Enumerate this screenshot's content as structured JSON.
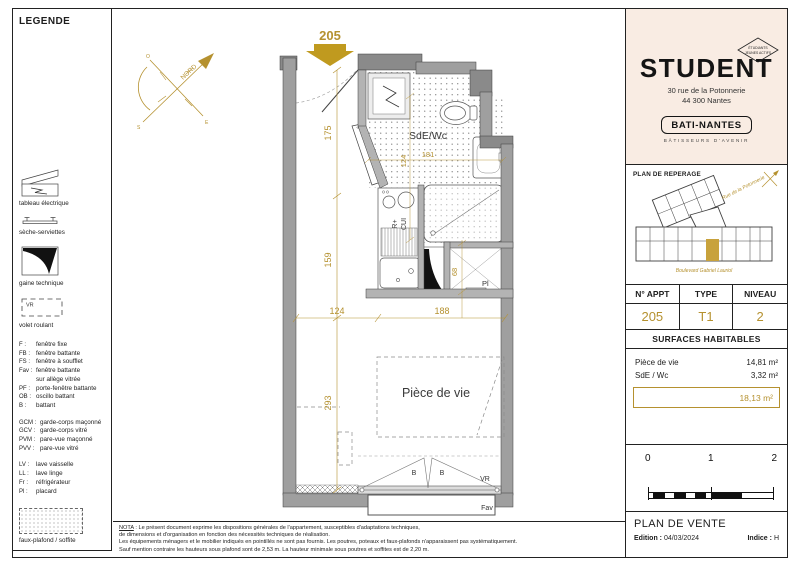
{
  "colors": {
    "accent": "#b5912f",
    "cream": "#f9ece3"
  },
  "legend": {
    "title": "LEGENDE",
    "items": [
      {
        "label": "tableau électrique"
      },
      {
        "label": "sèche-serviettes"
      },
      {
        "label": "gaine technique"
      },
      {
        "label": "volet roulant",
        "tag": "VR"
      }
    ],
    "abbrevs": [
      {
        "abbr": "F :",
        "label": "fenêtre fixe"
      },
      {
        "abbr": "FB :",
        "label": "fenêtre battante"
      },
      {
        "abbr": "FS :",
        "label": "fenêtre à soufflet"
      },
      {
        "abbr": "Fav :",
        "label": "fenêtre battante\nsur allège vitrée"
      },
      {
        "abbr": "PF :",
        "label": "porte-fenêtre battante"
      },
      {
        "abbr": "OB :",
        "label": "oscillo battant"
      },
      {
        "abbr": "B :",
        "label": "battant"
      }
    ],
    "abbrevs2": [
      {
        "abbr": "GCM :",
        "label": "garde-corps maçonné"
      },
      {
        "abbr": "GCV :",
        "label": "garde-corps vitré"
      },
      {
        "abbr": "PVM :",
        "label": "pare-vue maçonné"
      },
      {
        "abbr": "PVV :",
        "label": "pare-vue vitré"
      }
    ],
    "abbrevs3": [
      {
        "abbr": "LV :",
        "label": "lave vaisselle"
      },
      {
        "abbr": "LL :",
        "label": "lave linge"
      },
      {
        "abbr": "Fr :",
        "label": "réfrigérateur"
      },
      {
        "abbr": "Pl :",
        "label": "placard"
      }
    ],
    "faux_plafond": "faux-plafond / soffite"
  },
  "plan": {
    "unit": "205",
    "north": "NORD",
    "compass": {
      "o": "O",
      "e": "E",
      "s": "S"
    },
    "rooms": {
      "bath": "SdE/Wc",
      "living": "Pièce de vie"
    },
    "labels": {
      "pl": "Pl",
      "r": "R+",
      "cui": "CUI",
      "b_left": "B",
      "b_right": "B",
      "vr": "VR",
      "fav": "Fav"
    },
    "dims": {
      "d175": "175",
      "d159": "159",
      "d293": "293",
      "d124b": "124",
      "d181": "181",
      "d68": "68",
      "d124": "124",
      "d188": "188"
    }
  },
  "brand": {
    "name": "STUDENT",
    "badge_line1": "ÉTUDIANTS",
    "badge_line2": "JEUNES ACTIFS",
    "address1": "30 rue de la Potonnerie",
    "address2": "44 300 Nantes",
    "builder": "BATI-NANTES",
    "builder_tag": "BÂTISSEURS D'AVENIR"
  },
  "reperage": {
    "title": "PLAN DE REPERAGE",
    "street_top": "Rue de la Potonnerie",
    "street_bottom": "Boulevard Gabriel Lauriol"
  },
  "info_table": {
    "headers": [
      "N° APPT",
      "TYPE",
      "NIVEAU"
    ],
    "values": [
      "205",
      "T1",
      "2"
    ]
  },
  "surfaces": {
    "title": "SURFACES HABITABLES",
    "rows": [
      {
        "label": "Pièce de vie",
        "value": "14,81 m²"
      },
      {
        "label": "SdE / Wc",
        "value": "3,32 m²"
      }
    ],
    "total": "18,13 m²"
  },
  "scale": {
    "t0": "0",
    "t1": "1",
    "t2": "2"
  },
  "titleblock": {
    "title": "PLAN DE VENTE",
    "edition_label": "Edition :",
    "edition_value": "04/03/2024",
    "indice_label": "Indice :",
    "indice_value": "H"
  },
  "nota": {
    "prefix": "NOTA",
    "lines": [
      " : Le présent document exprime les dispositions générales de l'appartement, susceptibles d'adaptations techniques,",
      "de dimensions et d'organisation en fonction des nécessités techniques de réalisation.",
      "Les équipements ménagers et le mobilier indiqués en pointillés ne sont pas fournis. Les poutres, poteaux et faux-plafonds n'apparaissent pas systématiquement.",
      "Sauf mention contraire les hauteurs sous plafond sont de 2,53 m. La hauteur minimale sous poutres et soffites est de 2,20 m."
    ]
  }
}
